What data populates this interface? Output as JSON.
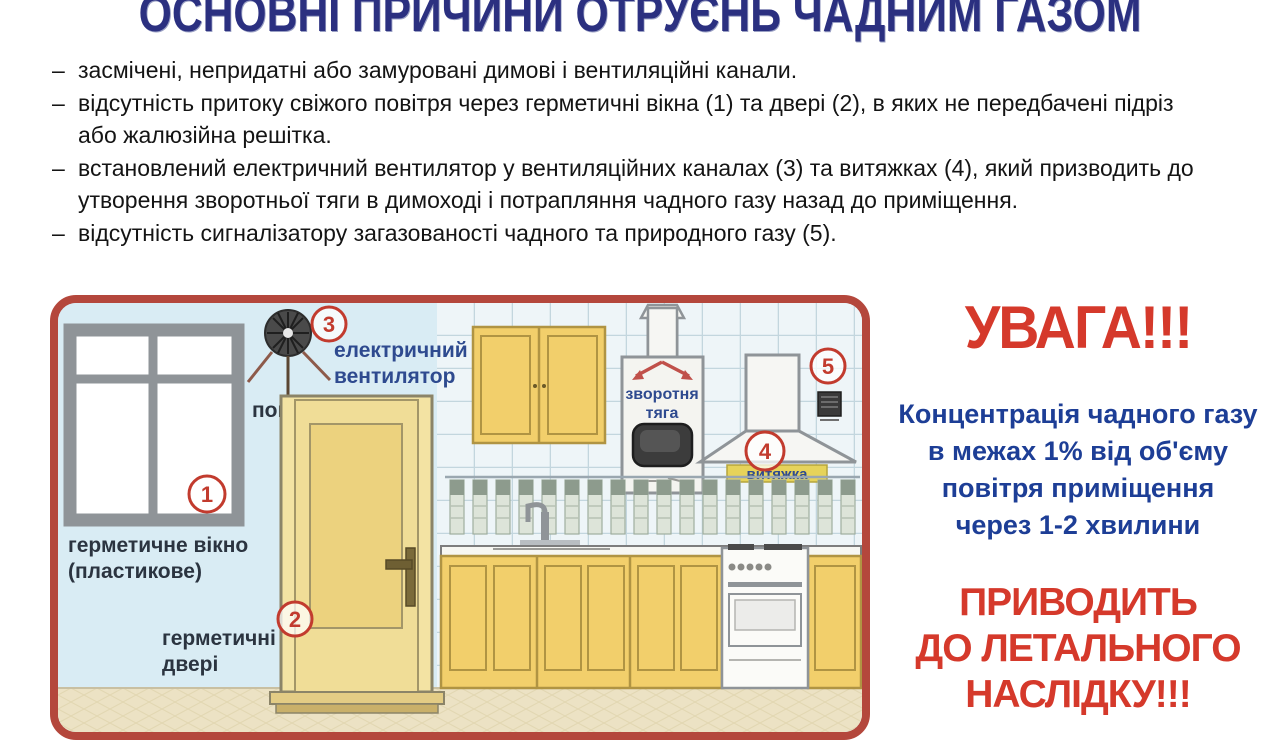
{
  "title": "ОСНОВНІ ПРИЧИНИ ОТРУЄНЬ ЧАДНИМ ГАЗОМ",
  "causes": [
    "засмічені, непридатні або замуровані димові і вентиляційні канали.",
    "відсутність притоку свіжого повітря через герметичні вікна (1) та двері (2), в яких не передбачені підріз або жалюзійна решітка.",
    "встановлений електричний вентилятор у вентиляційних каналах (3) та витяжках (4), який призводить до утворення зворотньої тяги в димоході і потрапляння чадного газу назад до приміщення.",
    "відсутність сигналізатору загазованості чадного та природного газу (5)."
  ],
  "diagram": {
    "markers": [
      "1",
      "2",
      "3",
      "4",
      "5"
    ],
    "labels": {
      "window_line1": "герметичне вікно",
      "window_line2": "(пластикове)",
      "door_line1": "герметичні",
      "door_line2": "двері",
      "fan_line1": "електричний",
      "fan_line2": "вентилятор",
      "air": "повітря",
      "draft_line1": "зворотня",
      "draft_line2": "тяга",
      "hood": "витяжка"
    }
  },
  "warning": {
    "heading": "УВАГА!!!",
    "body_lines": [
      "Концентрація чадного газу",
      "в межах 1% від об'єму",
      "повітря приміщення",
      "через 1-2 хвилини"
    ],
    "result_lines": [
      "ПРИВОДИТЬ",
      "ДО ЛЕТАЛЬНОГО",
      "НАСЛІДКУ!!!"
    ]
  },
  "colors": {
    "title_navy": "#2b3080",
    "warning_red": "#d5392b",
    "body_navy": "#1d3e96",
    "panel_border": "#b4473c",
    "panel_bg": "#d9ecf4",
    "cabinet_yellow": "#f2cf6b",
    "door_yellow": "#f3e3a3",
    "floor_beige": "#ece2c4"
  }
}
